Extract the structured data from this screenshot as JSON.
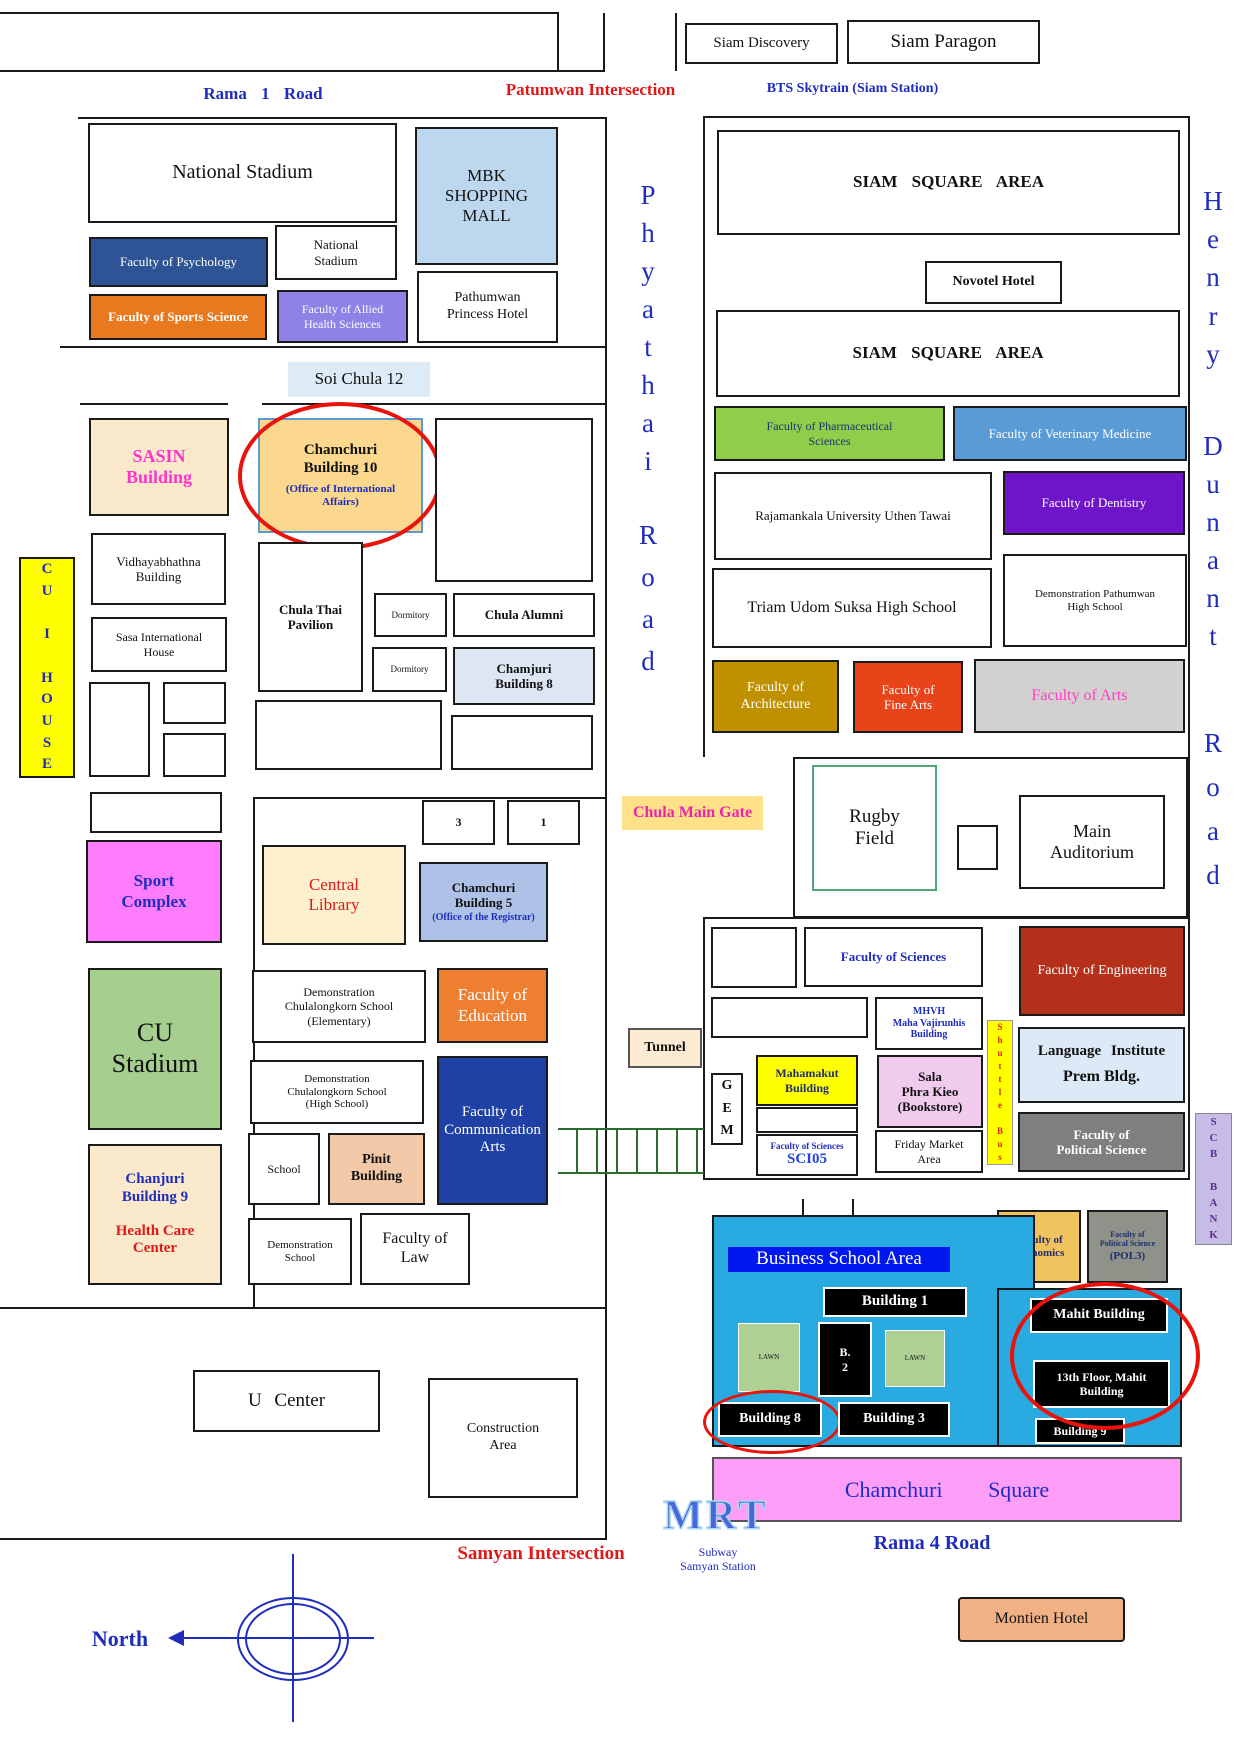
{
  "colors": {
    "road_line": "#1a1a1a",
    "red_highlight": "#e8140c",
    "psychology": "#2E5496",
    "sports_science": "#E8791E",
    "allied_health": "#8E82E6",
    "mbk": "#BDD7EE",
    "soi_label": "#DDEBF7",
    "sasin_cream": "#FBE9CB",
    "chamchuri10": "#FBD88D",
    "cu_i_house": "#FFFF00",
    "sport_complex": "#FF7DFC",
    "chamchuri5": "#AEC2E8",
    "cu_stadium": "#A6CE8E",
    "education": "#EE7E30",
    "comm_arts": "#1F41A5",
    "pinit": "#F2C9A8",
    "pharmaceutical": "#8FCE4A",
    "veterinary": "#5B9BD5",
    "dentistry": "#6F15C9",
    "architecture": "#BF9000",
    "fine_arts": "#E8441A",
    "arts_gray": "#D3D0D0",
    "engineering": "#B5301B",
    "language_institute": "#DCE9F6",
    "political_science": "#7F7F7F",
    "economics": "#F0C35E",
    "sala_pink": "#F0CBED",
    "business_cyan": "#29ABE2",
    "banner_blue": "#0018F0",
    "lawn_green": "#AFD095",
    "chamchuri_square": "#FF9EF9",
    "montien": "#F2B184",
    "scb": "#C7BCE8",
    "blue_text": "#1f2dbd",
    "red_text": "#E01818",
    "magenta_text": "#FF33CC"
  },
  "roads": {
    "rama1": "Rama 1 Road",
    "patumwan": "Patumwan Intersection",
    "bts": "BTS Skytrain (Siam Station)",
    "soi_chula": "Soi Chula 12",
    "phyathai": "Phyathai",
    "road": "Road",
    "henry": "Henry",
    "dunant": "Dunant",
    "chula_gate": "Chula Main Gate",
    "tunnel": "Tunnel",
    "shuttle_bus": "Shuttle Bus",
    "cu_i_house": "CU I HOUSE",
    "scb_bank": "SCB BANK",
    "samyan": "Samyan Intersection",
    "rama4": "Rama 4 Road",
    "north": "North",
    "mrt": "MRT",
    "subway": "Subway\nSamyan Station"
  },
  "b": {
    "siam_discovery": "Siam Discovery",
    "siam_paragon": "Siam Paragon",
    "national_stadium": "National Stadium",
    "mbk": "MBK\nSHOPPING\nMALL",
    "national_stadium_small": "National\nStadium",
    "psychology": "Faculty of Psychology",
    "sports_science": "Faculty of Sports Science",
    "allied_health": "Faculty of Allied\nHealth Sciences",
    "pathumwan_princess": "Pathumwan\nPrincess Hotel",
    "sasin": "SASIN\nBuilding",
    "chamchuri10": "Chamchuri\nBuilding 10",
    "chamchuri10_sub": "(Office of International\nAffairs)",
    "vidhayabhathna": "Vidhayabhathna\nBuilding",
    "sasa": "Sasa International\nHouse",
    "chula_thai": "Chula Thai\nPavilion",
    "dormitory": "Dormitory",
    "chula_alumni": "Chula Alumni",
    "chamjuri8": "Chamjuri\nBuilding 8",
    "num3": "3",
    "num1": "1",
    "sport_complex": "Sport\nComplex",
    "central_library": "Central\nLibrary",
    "chamchuri5": "Chamchuri\nBuilding 5",
    "chamchuri5_sub": "(Office of the Registrar)",
    "cu_stadium": "CU\nStadium",
    "demo_elementary": "Demonstration\nChulalongkorn School\n(Elementary)",
    "education": "Faculty of\nEducation",
    "demo_high": "Demonstration\nChulalongkorn School\n(High School)",
    "comm_arts": "Faculty of\nCommunication\nArts",
    "school": "School",
    "pinit": "Pinit\nBuilding",
    "chanjuri9": "Chanjuri\nBuilding 9",
    "health_care": "Health Care\nCenter",
    "demo_school": "Demonstration\nSchool",
    "law": "Faculty of\nLaw",
    "u_center": "U Center",
    "construction": "Construction\nArea",
    "siam_square": "SIAM SQUARE AREA",
    "novotel": "Novotel Hotel",
    "pharmaceutical": "Faculty of Pharmaceutical\nSciences",
    "veterinary": "Faculty of Veterinary Medicine",
    "rajamankala": "Rajamankala University Uthen Tawai",
    "dentistry": "Faculty of Dentistry",
    "triam_udom": "Triam Udom Suksa High School",
    "demo_pathumwan": "Demonstration Pathumwan\nHigh School",
    "architecture": "Faculty of\nArchitecture",
    "fine_arts": "Faculty of\nFine Arts",
    "arts": "Faculty of Arts",
    "rugby": "Rugby\nField",
    "main_auditorium": "Main\nAuditorium",
    "sciences": "Faculty of Sciences",
    "engineering": "Faculty of Engineering",
    "mhvh": "MHVH\nMaha Vajirunhis\nBuilding",
    "gem": "GEM",
    "mahamakut": "Mahamakut\nBuilding",
    "sci05_dept": "Faculty of Sciences",
    "sci05": "SCI05",
    "sala": "Sala\nPhra Kieo\n(Bookstore)",
    "friday_market": "Friday Market\nArea",
    "language_institute": "Language Institute",
    "prem": "Prem Bldg.",
    "political_science": "Faculty of\nPolitical Science",
    "economics": "Faculty of\nEconomics",
    "pol3_dept": "Faculty of\nPolitical Science",
    "pol3": "(POL3)",
    "business_area": "Business School Area",
    "building1": "Building 1",
    "b2": "B.\n2",
    "lawn": "LAWN",
    "building8": "Building 8",
    "building3": "Building 3",
    "mahit": "Mahit Building",
    "floor13": "13th Floor, Mahit\nBuilding",
    "building9": "Building 9",
    "chamchuri_square": "Chamchuri Square",
    "montien": "Montien Hotel"
  }
}
